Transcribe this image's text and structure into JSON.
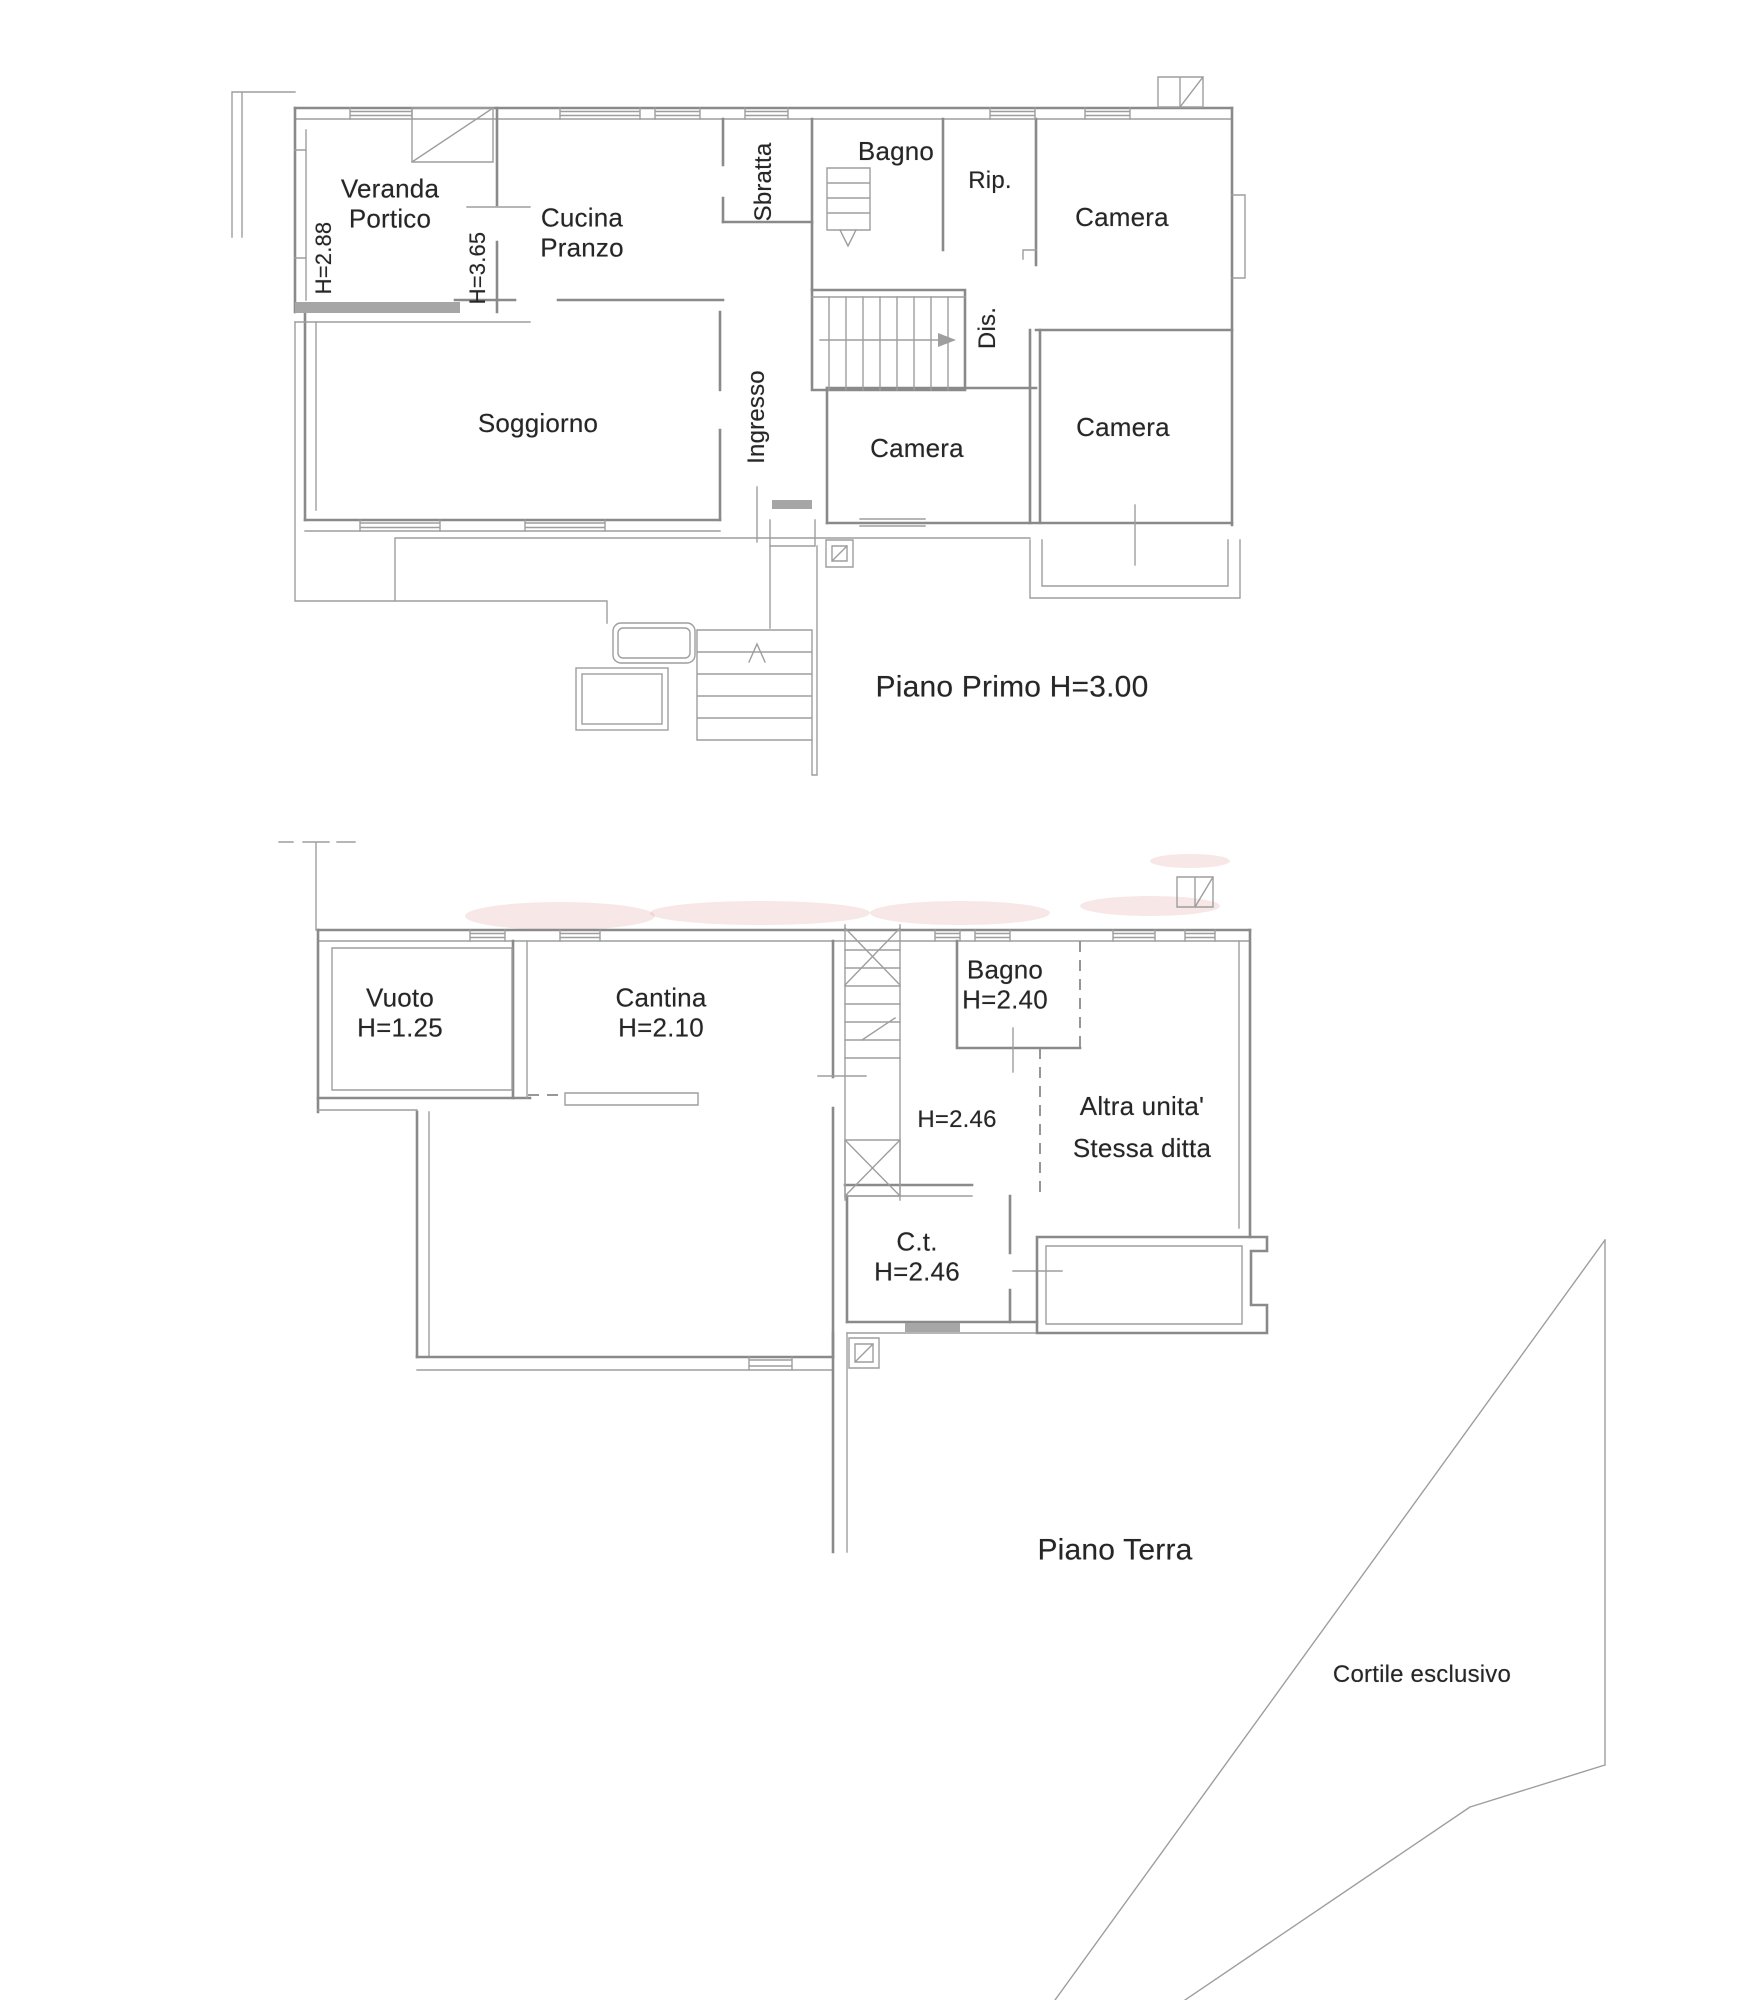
{
  "palette": {
    "wall": "#8a8a8a",
    "thin": "#9e9e9e",
    "band": "#a6a6a6",
    "text": "#262626",
    "wm": "#d98686",
    "bg": "#ffffff"
  },
  "floor1": {
    "caption": "Piano Primo H=3.00",
    "rooms": {
      "veranda": "Veranda\nPortico",
      "veranda_h": "H=2.88",
      "cucina": "Cucina\nPranzo",
      "cucina_h": "H=3.65",
      "sbratta": "Sbratta",
      "bagno": "Bagno",
      "rip": "Rip.",
      "camera_ne": "Camera",
      "dis": "Dis.",
      "soggiorno": "Soggiorno",
      "ingresso": "Ingresso",
      "camera_c": "Camera",
      "camera_se": "Camera"
    }
  },
  "floor0": {
    "caption": "Piano Terra",
    "rooms": {
      "vuoto": "Vuoto\nH=1.25",
      "cantina": "Cantina\nH=2.10",
      "bagno": "Bagno\nH=2.40",
      "hall_h": "H=2.46",
      "altra": "Altra unita'\nStessa ditta",
      "ct": "C.t.\nH=2.46",
      "cortile": "Cortile esclusivo"
    }
  }
}
